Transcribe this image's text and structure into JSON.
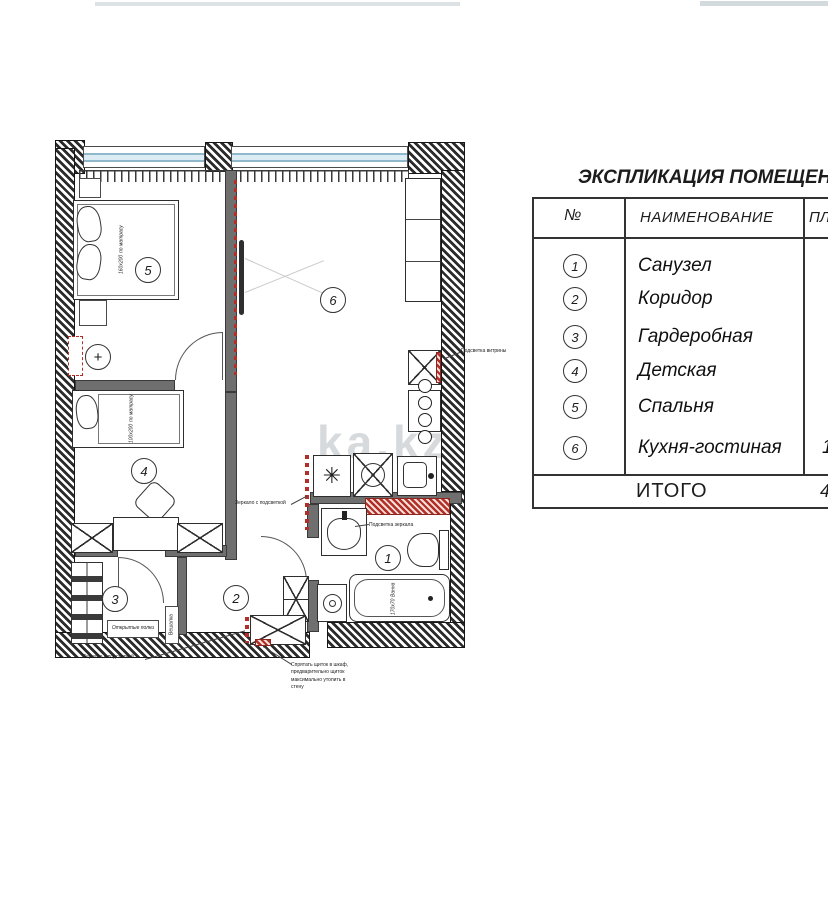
{
  "header": {
    "title": "ЭКСПЛИКАЦИЯ ПОМЕЩЕНИЙ"
  },
  "table": {
    "col_num": "№",
    "col_name": "НАИМЕНОВАНИЕ",
    "col_area": "ПЛОЩАДЬ",
    "rows": [
      {
        "num": "1",
        "name": "Санузел",
        "area": ""
      },
      {
        "num": "2",
        "name": "Коридор",
        "area": ""
      },
      {
        "num": "3",
        "name": "Гардеробная",
        "area": ""
      },
      {
        "num": "4",
        "name": "Детская",
        "area": ""
      },
      {
        "num": "5",
        "name": "Спальня",
        "area": ""
      },
      {
        "num": "6",
        "name": "Кухня-гостиная",
        "area": "1"
      }
    ],
    "total_label": "ИТОГО",
    "total_value": "4"
  },
  "plan": {
    "room_numbers": {
      "r1": "1",
      "r2": "2",
      "r3": "3",
      "r4": "4",
      "r5": "5",
      "r6": "6"
    },
    "labels": {
      "bed_master_size": "160х200",
      "bed_master_note": "по матрасу",
      "bed_kids_size": "100х200",
      "bed_kids_note": "по матрасу",
      "bath_name": "Ванна",
      "bath_size": "170х70",
      "open_shelves": "Открытые полки",
      "hanger": "Вешалка",
      "mirror_backlit_wardrobe": "Зеркало с подсветкой",
      "mirror_backlit_kitchen": "Зеркало с подсветкой",
      "mirror_light": "Подсветка зеркала",
      "vitrine_light": "Подсветка витрины",
      "panel_note": "Спрятать щиток в шкаф, предварительно щиток максимально утопить в стену"
    },
    "icons": {
      "freezer": "✳",
      "light_plus": "+"
    }
  },
  "watermark": "ka.kz",
  "colors": {
    "accent_red": "#b03028",
    "window_blue": "#8fb8cc",
    "line_dark": "#2b2b2b"
  }
}
